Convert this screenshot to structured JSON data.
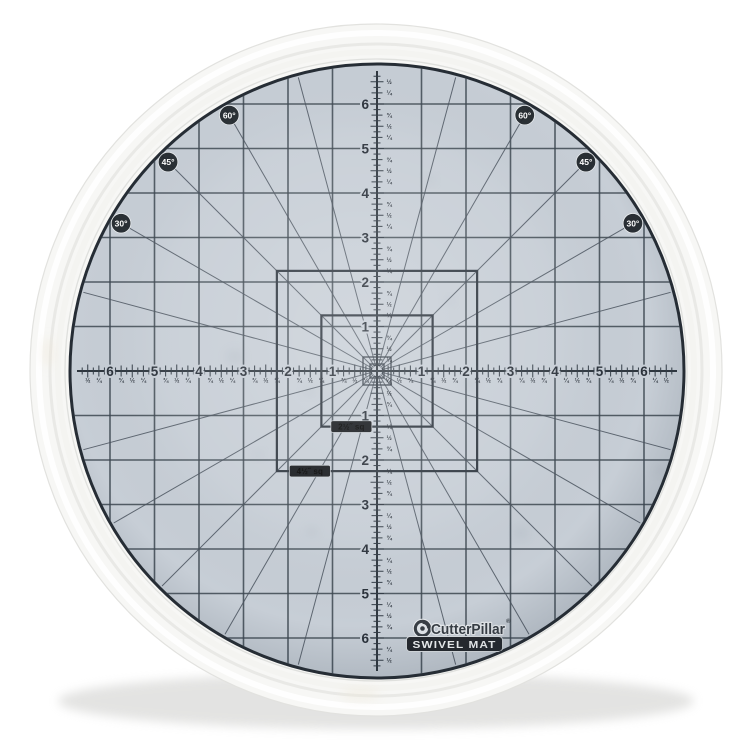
{
  "product": {
    "brand": "CutterPillar",
    "registered_mark": "®",
    "name": "SWIVEL MAT"
  },
  "mat": {
    "ruler": {
      "unit_numbers": [
        "1",
        "2",
        "3",
        "4",
        "5",
        "6"
      ],
      "fraction_labels": [
        "¼",
        "½",
        "¾"
      ]
    },
    "angle_badges": [
      {
        "label": "30°",
        "degrees": 30
      },
      {
        "label": "45°",
        "degrees": 45
      },
      {
        "label": "60°",
        "degrees": 60
      }
    ],
    "square_tags": [
      {
        "label": "2½˝ sq",
        "inches": 2.5
      },
      {
        "label": "4½˝ sq",
        "inches": 4.5
      }
    ],
    "colors": {
      "mat_surface": "#c7ced6",
      "grid_line": "#3d4750",
      "ruler_ink": "#2b323b",
      "badge_bg": "#21262c",
      "badge_text": "#ffffff",
      "tag_bg": "#15181c",
      "tag_text": "#eef0f2",
      "logo_ink": "#383e45",
      "base_plastic": "#f7f7f5"
    }
  }
}
